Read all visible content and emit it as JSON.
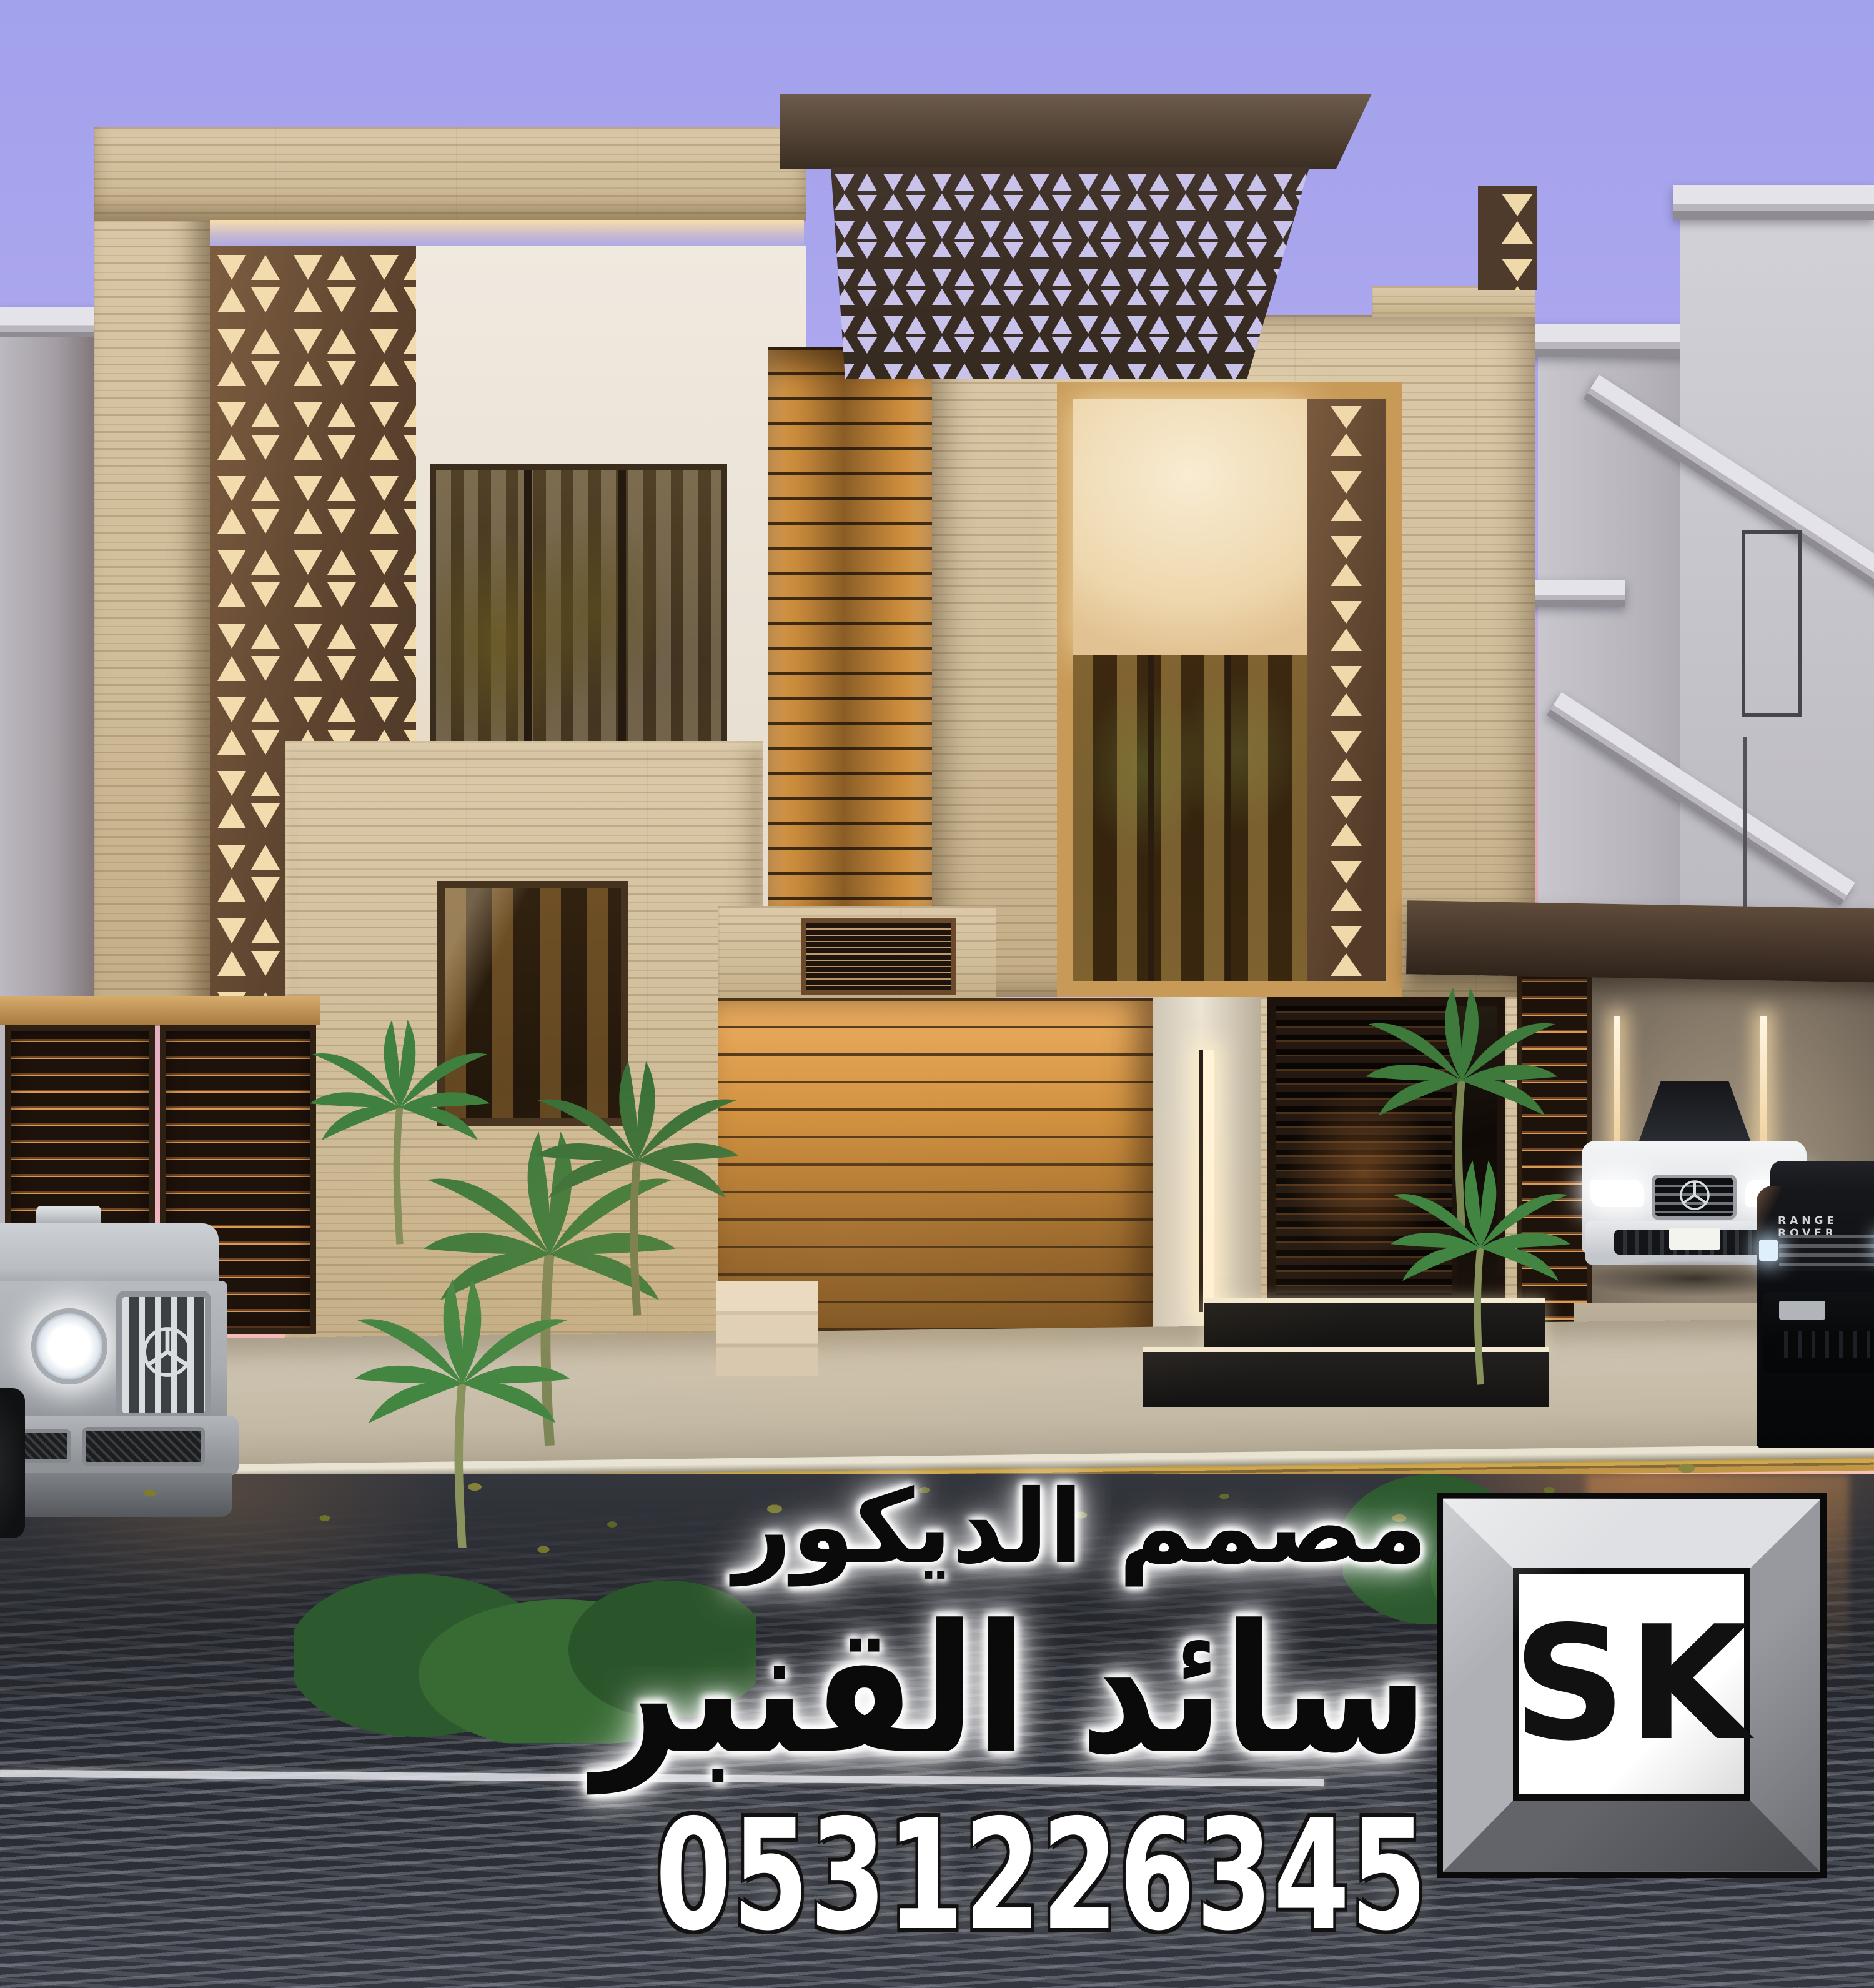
{
  "watermark": {
    "profession": "مصمم الديكور",
    "name": "سائد القنبر",
    "phone": "0531226345"
  },
  "logo": {
    "monogram": "SK"
  },
  "vehicles": {
    "range_rover_badge": "RANGE ROVER"
  },
  "colors": {
    "sky-top": "#a2a1ec",
    "sky-mid": "#c6b1e7",
    "sky-pink": "#f4b6ba",
    "trav": "#d3c1a0",
    "trav-dark": "#b49d78",
    "wood": "#c98f42",
    "wood-deep": "#7c5322",
    "panel-brown": "#6b4e35",
    "panel-cut": "#f2dcae",
    "canopy": "#4c3c2f",
    "white-wall": "#ece5d9",
    "glass": "#201708",
    "street": "#26282e",
    "metal-light": "#dfe0e3",
    "metal-dark": "#63646a",
    "led": "#fff3d8",
    "gate-glow": "#d99a55"
  }
}
